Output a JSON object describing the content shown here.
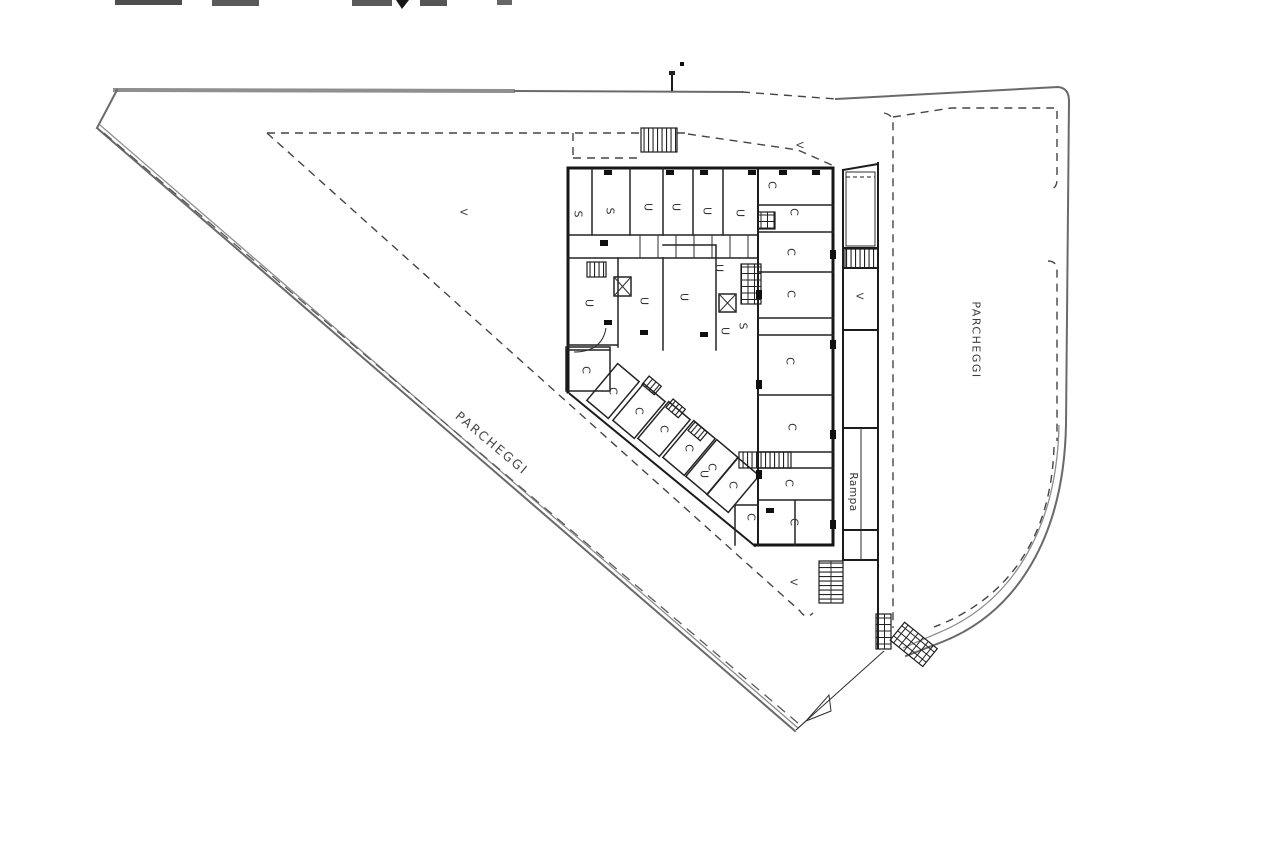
{
  "plan": {
    "colors": {
      "background": "#ffffff",
      "wall": "#161616",
      "boundary_gray": "#8f8f8f",
      "dashed_line": "#454545",
      "text": "#3a3a3a"
    },
    "area_labels": [
      {
        "id": "parcheggi-right",
        "text": "PARCHEGGI"
      },
      {
        "id": "parcheggi-diagonal",
        "text": "PARCHEGGI"
      },
      {
        "id": "rampa",
        "text": "Rampa"
      }
    ],
    "room_labels": [
      {
        "text": "S",
        "x": 578,
        "y": 214
      },
      {
        "text": "S",
        "x": 610,
        "y": 211
      },
      {
        "text": "U",
        "x": 648,
        "y": 207
      },
      {
        "text": "U",
        "x": 676,
        "y": 207
      },
      {
        "text": "U",
        "x": 707,
        "y": 211
      },
      {
        "text": "U",
        "x": 740,
        "y": 213
      },
      {
        "text": "C",
        "x": 772,
        "y": 185
      },
      {
        "text": "C",
        "x": 794,
        "y": 212
      },
      {
        "text": "C",
        "x": 791,
        "y": 252
      },
      {
        "text": "C",
        "x": 791,
        "y": 294
      },
      {
        "text": "U",
        "x": 589,
        "y": 303
      },
      {
        "text": "U",
        "x": 644,
        "y": 301
      },
      {
        "text": "U",
        "x": 684,
        "y": 297
      },
      {
        "text": "U",
        "x": 719,
        "y": 268
      },
      {
        "text": "U",
        "x": 725,
        "y": 331
      },
      {
        "text": "S",
        "x": 743,
        "y": 326
      },
      {
        "text": "C",
        "x": 790,
        "y": 361
      },
      {
        "text": "C",
        "x": 792,
        "y": 427
      },
      {
        "text": "C",
        "x": 789,
        "y": 483
      },
      {
        "text": "C",
        "x": 794,
        "y": 522
      },
      {
        "text": "C",
        "x": 751,
        "y": 517
      },
      {
        "text": "C",
        "x": 586,
        "y": 370
      },
      {
        "text": "C",
        "x": 613,
        "y": 391
      },
      {
        "text": "C",
        "x": 639,
        "y": 411
      },
      {
        "text": "C",
        "x": 664,
        "y": 429
      },
      {
        "text": "C",
        "x": 689,
        "y": 448
      },
      {
        "text": "U",
        "x": 704,
        "y": 474
      },
      {
        "text": "C",
        "x": 712,
        "y": 467
      },
      {
        "text": "C",
        "x": 733,
        "y": 485
      }
    ],
    "vent_labels": [
      {
        "text": "V",
        "x": 463,
        "y": 212
      },
      {
        "text": "V",
        "x": 799,
        "y": 145
      },
      {
        "text": "V",
        "x": 859,
        "y": 296
      },
      {
        "text": "V",
        "x": 793,
        "y": 582
      }
    ]
  }
}
